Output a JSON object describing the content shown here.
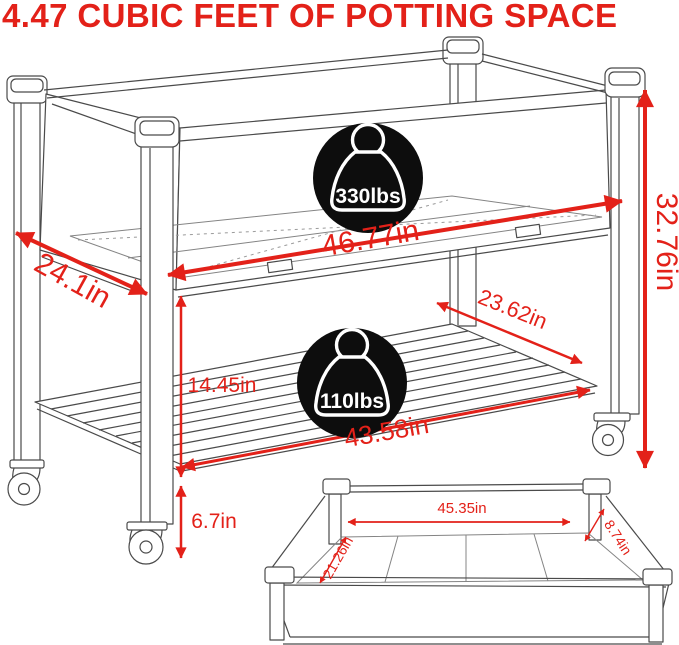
{
  "title": "4.47 CUBIC FEET OF POTTING SPACE",
  "colors": {
    "accent_red": "#E32119",
    "line": "#4A4A4A",
    "badge_bg": "#0D0D0D",
    "badge_text": "#FFFFFF"
  },
  "badges": {
    "upper": {
      "icon": "weight-icon",
      "label": "330lbs"
    },
    "lower": {
      "icon": "weight-icon",
      "label": "110lbs"
    }
  },
  "dimensions": {
    "bed_length": "46.77in",
    "bed_depth": "24.1in",
    "overall_height": "32.76in",
    "shelf_depth": "23.62in",
    "bed_to_shelf": "14.45in",
    "shelf_length": "43.58in",
    "ground_clearance": "6.7in"
  },
  "inset": {
    "inner_length": "45.35in",
    "inner_width": "21.26in",
    "inner_depth": "8.74in"
  }
}
